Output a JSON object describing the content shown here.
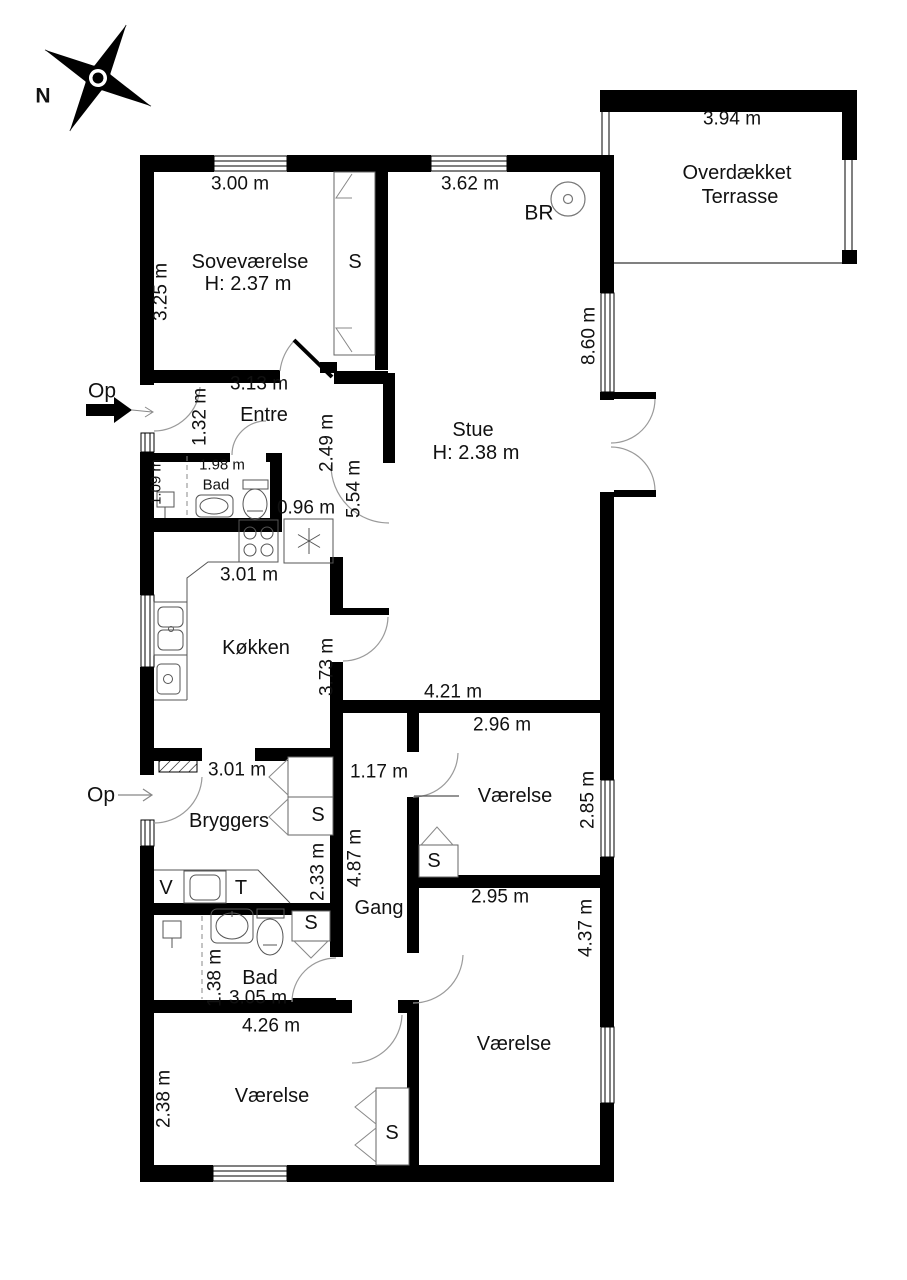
{
  "compass": {
    "north": "N"
  },
  "entrances": {
    "op1": "Op",
    "op2": "Op"
  },
  "detector": {
    "br": "BR"
  },
  "fixtures": {
    "closet": "S",
    "washer": "V",
    "dryer": "T"
  },
  "rooms": {
    "soveverelse": {
      "name": "Soveværelse",
      "ceiling": "H: 2.37 m"
    },
    "stue": {
      "name": "Stue",
      "ceiling": "H: 2.38 m"
    },
    "entre": {
      "name": "Entre"
    },
    "bad_upper": {
      "name": "Bad"
    },
    "kokken": {
      "name": "Køkken"
    },
    "bryggers": {
      "name": "Bryggers"
    },
    "gang": {
      "name": "Gang"
    },
    "bad_lower": {
      "name": "Bad"
    },
    "vaerelse_mid": {
      "name": "Værelse"
    },
    "vaerelse_se": {
      "name": "Værelse"
    },
    "vaerelse_sw": {
      "name": "Værelse"
    },
    "terrasse": {
      "line1": "Overdækket",
      "line2": "Terrasse"
    }
  },
  "dims": {
    "d300": "3.00 m",
    "d362": "3.62 m",
    "d394": "3.94 m",
    "d325": "3.25 m",
    "d313": "3.13 m",
    "d132": "1.32 m",
    "d249": "2.49 m",
    "d554": "5.54 m",
    "d198": "1.98 m",
    "d109": "1.09 m",
    "d096": "0.96 m",
    "d860": "8.60 m",
    "d301k": "3.01 m",
    "d373": "3.73 m",
    "d301b": "3.01 m",
    "d117": "1.17 m",
    "d421": "4.21 m",
    "d296": "2.96 m",
    "d285": "2.85 m",
    "d233": "2.33 m",
    "d487": "4.87 m",
    "d295": "2.95 m",
    "d437": "4.37 m",
    "d138": "1.38 m",
    "d305": "3.05 m",
    "d426": "4.26 m",
    "d238": "2.38 m"
  }
}
